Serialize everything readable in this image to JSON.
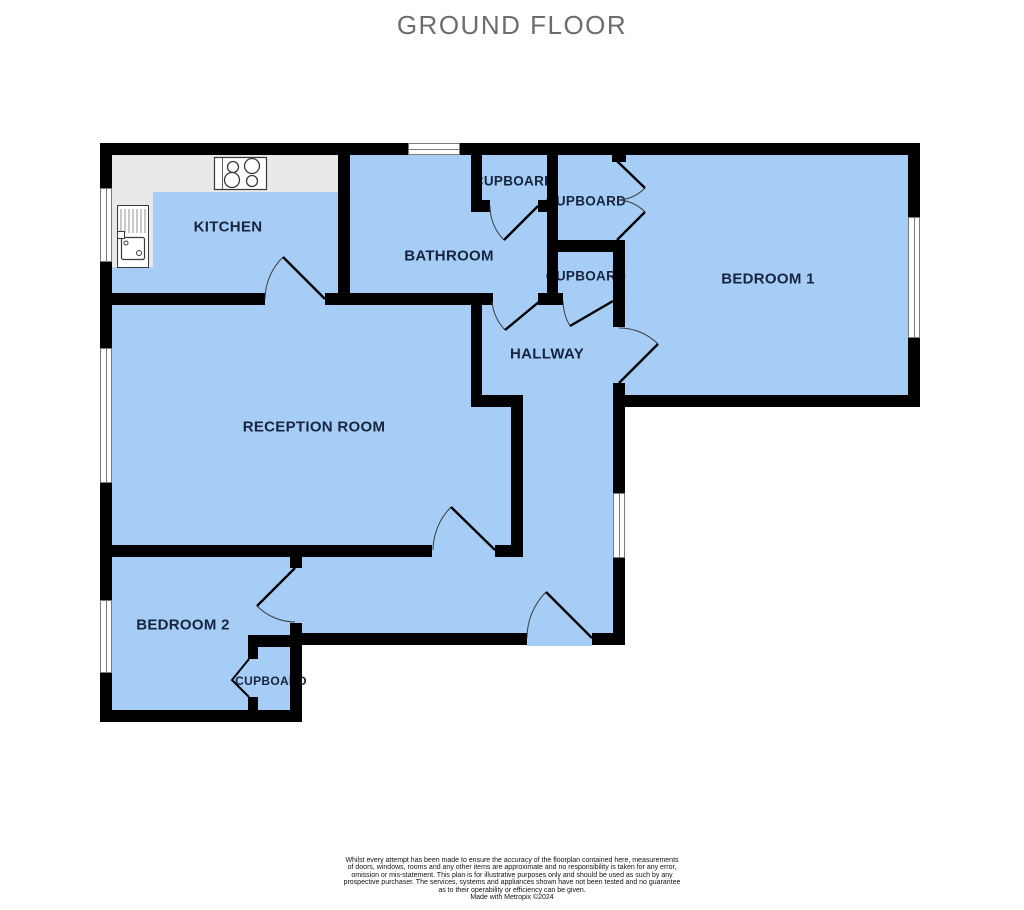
{
  "title": "GROUND FLOOR",
  "rooms": {
    "kitchen": {
      "label": "KITCHEN"
    },
    "bathroom": {
      "label": "BATHROOM"
    },
    "cupboard_top": {
      "label": "CUPBOARD"
    },
    "cupboard_mid_upper": {
      "label": "CUPBOARD"
    },
    "cupboard_mid_lower": {
      "label": "CUPBOARD"
    },
    "bedroom1": {
      "label": "BEDROOM 1"
    },
    "hallway": {
      "label": "HALLWAY"
    },
    "reception": {
      "label": "RECEPTION ROOM"
    },
    "bedroom2": {
      "label": "BEDROOM 2"
    },
    "cupboard_bedroom2": {
      "label": "CUPBOARD"
    }
  },
  "colors": {
    "room_fill": "#a6cdf6",
    "wall": "#000000",
    "counter": "#e9e9e9",
    "window_frame": "#7a7a7a",
    "title_text": "#6d6d6d",
    "label_text": "#18243e",
    "door_arc": "#3c3c3c"
  },
  "footer": {
    "disclaimer_lines": [
      "Whilst every attempt has been made to ensure the accuracy of the floorplan contained here, measurements",
      "of doors, windows, rooms and any other items are approximate and no responsibility is taken for any error,",
      "omission or mis-statement. This plan is for illustrative purposes only and should be used as such by any",
      "prospective purchaser. The services, systems and appliances shown have not been tested and no guarantee",
      "as to their operability or efficiency can be given."
    ],
    "credit": "Made with Metropix ©2024"
  }
}
